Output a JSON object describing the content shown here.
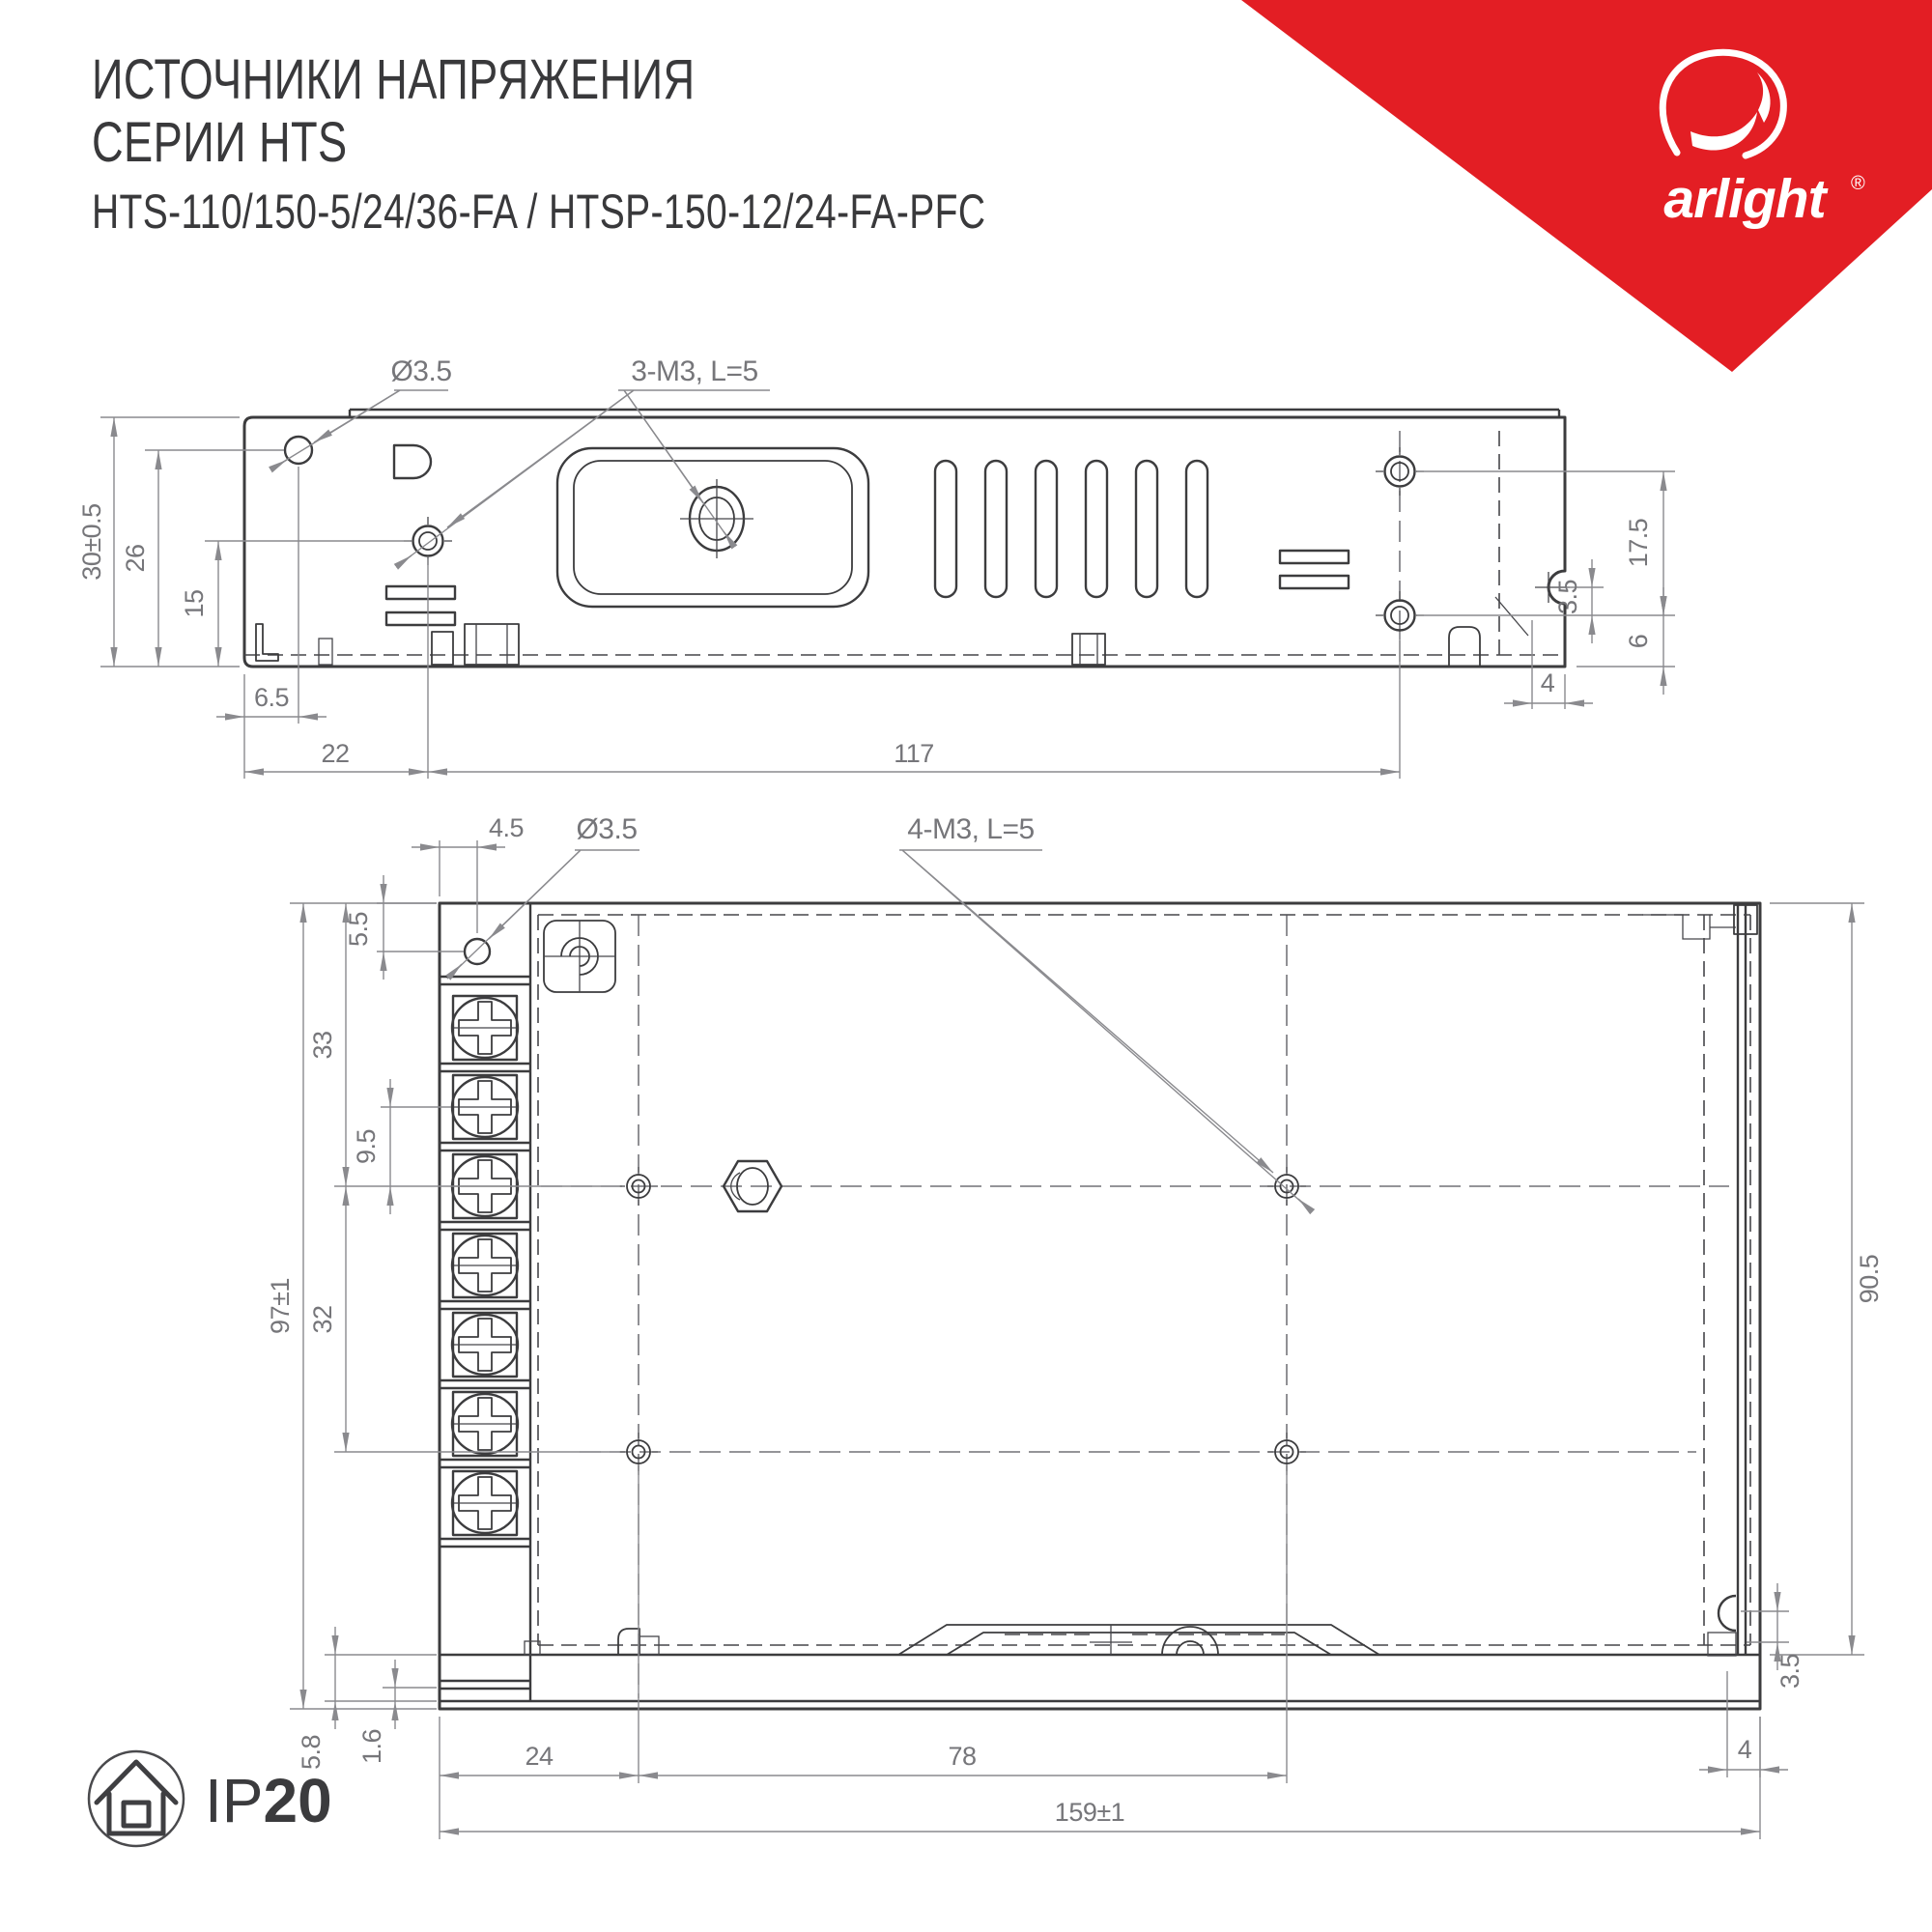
{
  "header": {
    "title_line1": "ИСТОЧНИКИ НАПРЯЖЕНИЯ",
    "title_line2": "СЕРИИ HTS",
    "title_line3": "HTS-110/150-5/24/36-FA / HTSP-150-12/24-FA-PFC"
  },
  "logo": {
    "brand": "arlight",
    "registered": "®"
  },
  "side_view": {
    "label_hole": "Ø3.5",
    "label_screws": "3-M3, L=5",
    "dim_height": "30±0.5",
    "dim_hole_from_bottom": "26",
    "dim_screw_from_bottom": "15",
    "dim_hole_from_left": "6.5",
    "dim_screw_from_left": "22",
    "dim_screw_span": "117",
    "dim_right_span": "17.5",
    "dim_notch_offset": "3.5",
    "dim_bottom_screw": "6",
    "dim_notch_depth": "4"
  },
  "top_view": {
    "label_hole_offset": "4.5",
    "label_hole": "Ø3.5",
    "label_screws": "4-M3, L=5",
    "dim_hole_from_top": "5.5",
    "dim_row_from_top": "33",
    "dim_terminal_pitch": "9.5",
    "dim_height": "97±1",
    "dim_row_spacing": "32",
    "dim_inner_depth": "90.5",
    "dim_wall_a": "5.8",
    "dim_wall_b": "1.6",
    "dim_terminal_width": "24",
    "dim_screw_span": "78",
    "dim_length": "159±1",
    "dim_right_wall": "4",
    "dim_right_notch": "3.5"
  },
  "footer": {
    "ip_prefix": "IP",
    "ip_value": "20"
  },
  "colors": {
    "accent": "#E31E24",
    "line": "#3C3C3E",
    "dim": "#8A8A8E"
  }
}
